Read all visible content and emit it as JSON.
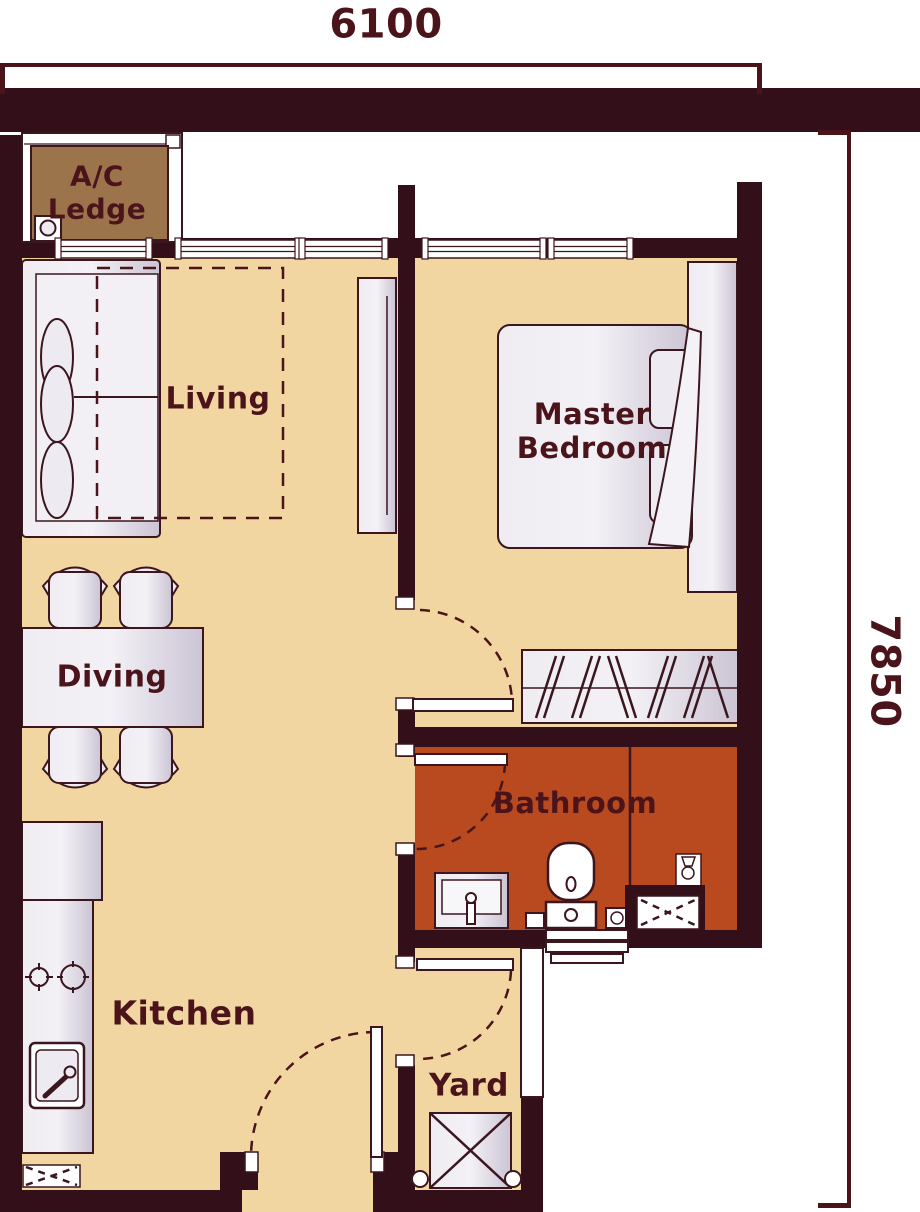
{
  "title": "apartment-floor-plan",
  "dimensions": {
    "width_label": "6100",
    "height_label": "7850"
  },
  "rooms": {
    "ac_ledge_line1": "A/C",
    "ac_ledge_line2": "Ledge",
    "living": "Living",
    "dining": "Diving",
    "master_bedroom": "Master\nBedroom",
    "bathroom": "Bathroom",
    "kitchen": "Kitchen",
    "yard": "Yard"
  },
  "colors": {
    "wall": "#331019",
    "floor": "#f2d6a1",
    "bath": "#b94a20",
    "ledge": "#9b744c",
    "line": "#3b161e",
    "dim": "#4b141b",
    "text": "#4b141b",
    "white": "#ffffff"
  }
}
